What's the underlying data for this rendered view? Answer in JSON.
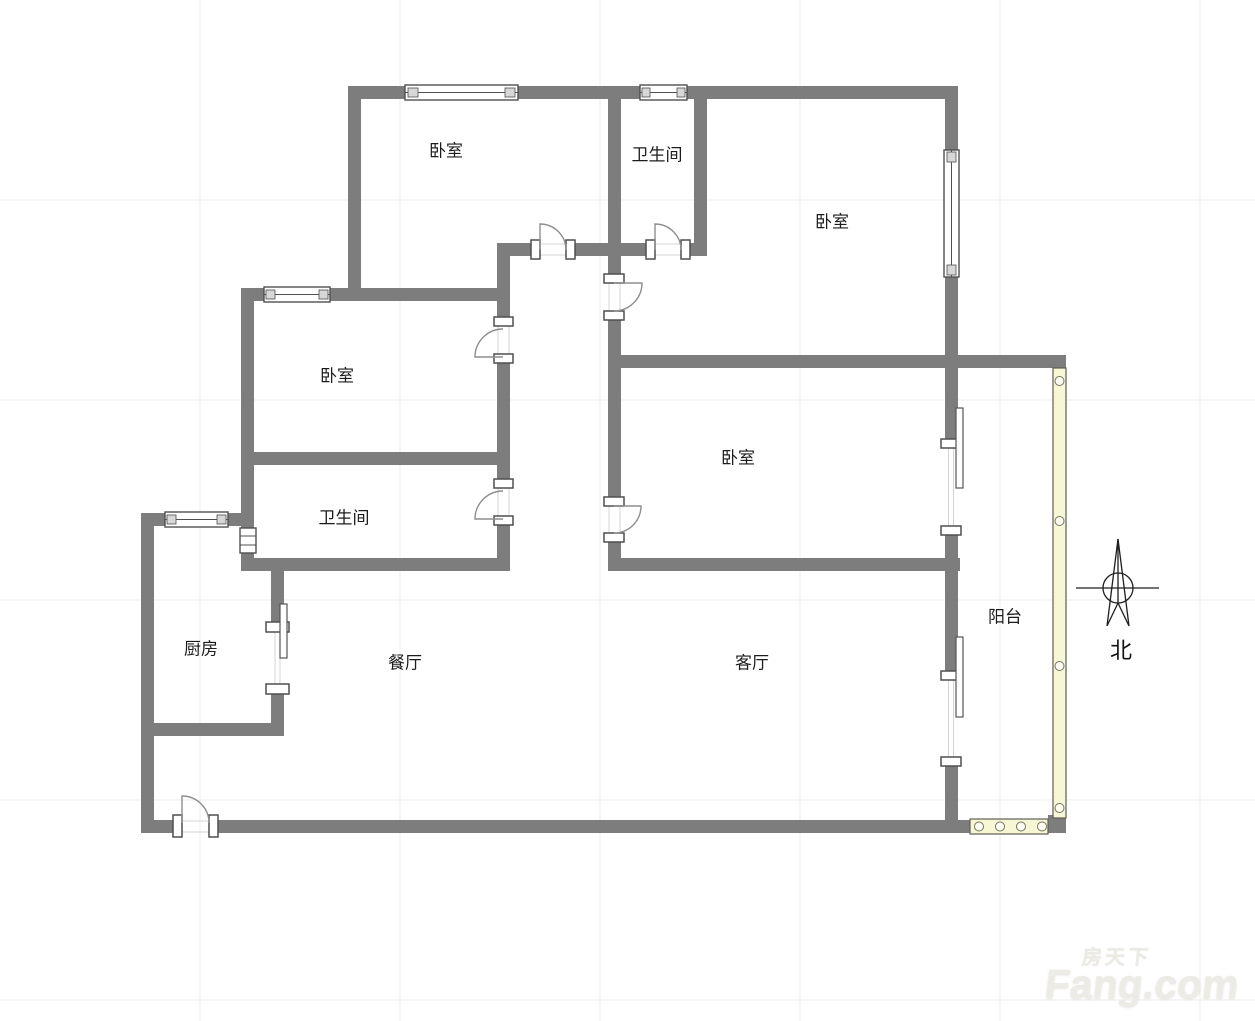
{
  "page": {
    "background": "#ffffff"
  },
  "floorplan": {
    "rooms": [
      {
        "id": "bedroom-top-left",
        "label": "卧室"
      },
      {
        "id": "bathroom-top",
        "label": "卫生间"
      },
      {
        "id": "bedroom-top-right",
        "label": "卧室"
      },
      {
        "id": "bedroom-mid-left",
        "label": "卧室"
      },
      {
        "id": "bathroom-mid",
        "label": "卫生间"
      },
      {
        "id": "kitchen",
        "label": "厨房"
      },
      {
        "id": "dining-room",
        "label": "餐厅"
      },
      {
        "id": "living-room",
        "label": "客厅"
      },
      {
        "id": "bedroom-right",
        "label": "卧室"
      },
      {
        "id": "balcony",
        "label": "阳台"
      }
    ],
    "compass": {
      "label": "北"
    },
    "colors": {
      "wall": "#7d7d7d",
      "glass": "#f7f7d6",
      "grid": "#ececea",
      "text": "#1c1c1c",
      "door": "#8e8e8e",
      "frame": "#4f4f4f"
    }
  },
  "watermark": {
    "brand_cn": "房天下",
    "brand": "Fang.com"
  }
}
